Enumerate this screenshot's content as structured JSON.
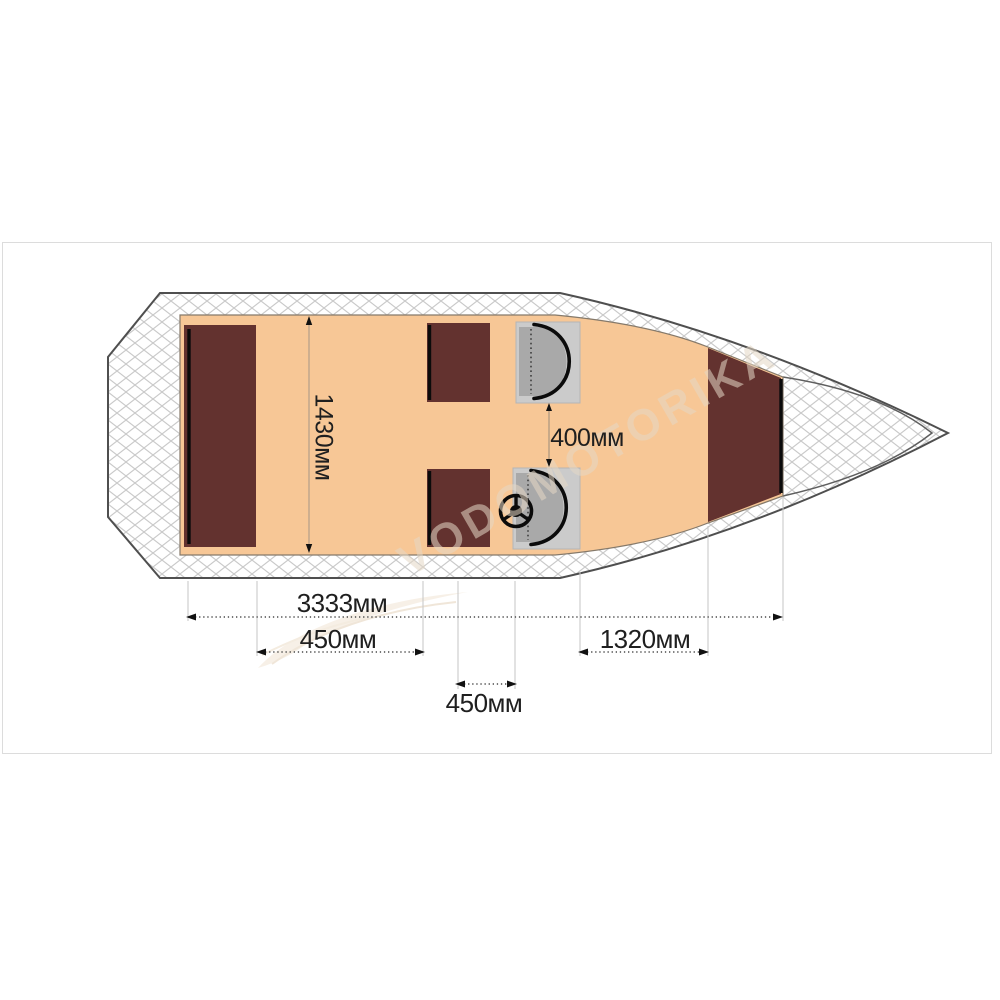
{
  "frame": {
    "border_color": "#dcdcdc"
  },
  "watermark": {
    "text": "VODOMOTORIKA"
  },
  "labels": {
    "width_1430": "1430мм",
    "gap_400": "400мм",
    "length_3333": "3333мм",
    "span_450_a": "450мм",
    "span_1320": "1320мм",
    "span_450_b": "450мм"
  },
  "colors": {
    "deck": "#f7c796",
    "bench": "#63322f",
    "seat_base": "#cbcbcb",
    "seat_cushion": "#a9a9a9",
    "transom_bracket": "#ababab",
    "hatch_line": "#c9c9c9",
    "watermark": "#e5d8c6"
  }
}
